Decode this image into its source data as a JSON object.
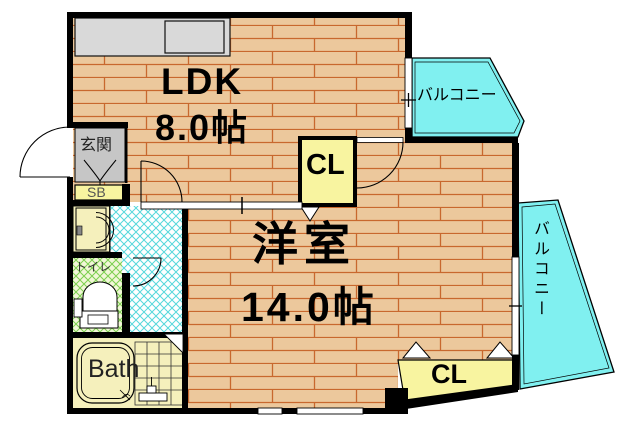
{
  "plan": {
    "ldk": {
      "name": "LDK",
      "area": "8.0帖"
    },
    "western_room": {
      "name": "洋室",
      "area": "14.0帖"
    },
    "closet_upper": {
      "name": "CL"
    },
    "closet_lower": {
      "name": "CL"
    },
    "balcony_top": {
      "name": "バルコニー"
    },
    "balcony_right": {
      "name": "バルコニー"
    },
    "entrance": {
      "name": "玄関"
    },
    "shoe_box": {
      "name": "SB"
    },
    "toilet": {
      "name": "トイレ"
    },
    "bath": {
      "name": "Bath"
    }
  },
  "colors": {
    "wood_floor": "#ecc89c",
    "wood_line": "#c8682e",
    "balcony": "#80f0f0",
    "corridor_hatch": "#55d8dc",
    "toilet_hatch": "#7ccf4f",
    "toilet_bg": "#f2f7d8",
    "closet_yellow": "#f8f4a0",
    "bath_yellow": "#f5f0bc",
    "entrance_gray": "#c6c6c6",
    "counter_gray": "#d9d9d9",
    "wall": "#000000"
  }
}
